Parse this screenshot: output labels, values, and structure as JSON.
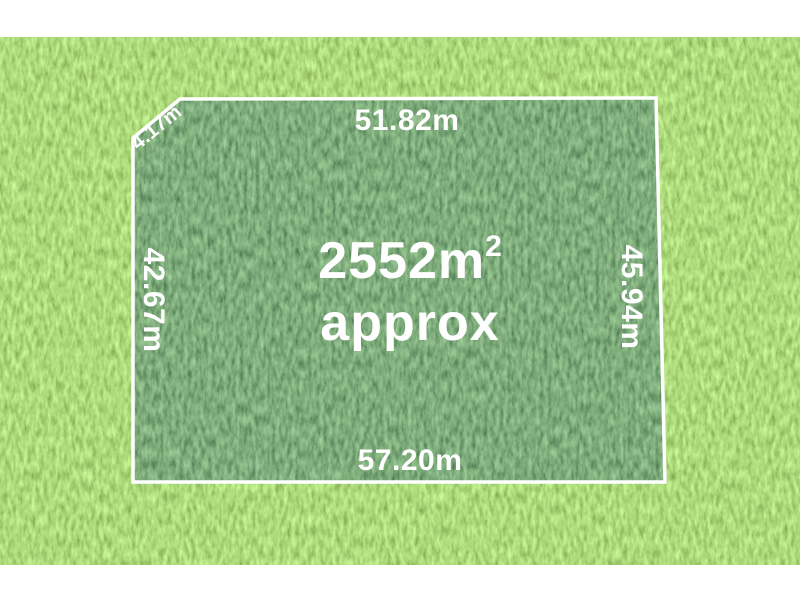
{
  "listing": {
    "type": "land-plot-dimension-diagram",
    "area_value": "2552m",
    "area_superscript": "2",
    "area_qualifier": "approx",
    "dimensions": {
      "top": "51.82m",
      "bottom": "57.20m",
      "left": "42.67m",
      "right": "45.94m",
      "corner": "4.17m"
    },
    "colors": {
      "outline": "#ffffff",
      "label_text": "#ffffff",
      "grass_outer_average": "#6bb433",
      "grass_inner_average": "#336c33",
      "page_border": "#ffffff"
    }
  }
}
